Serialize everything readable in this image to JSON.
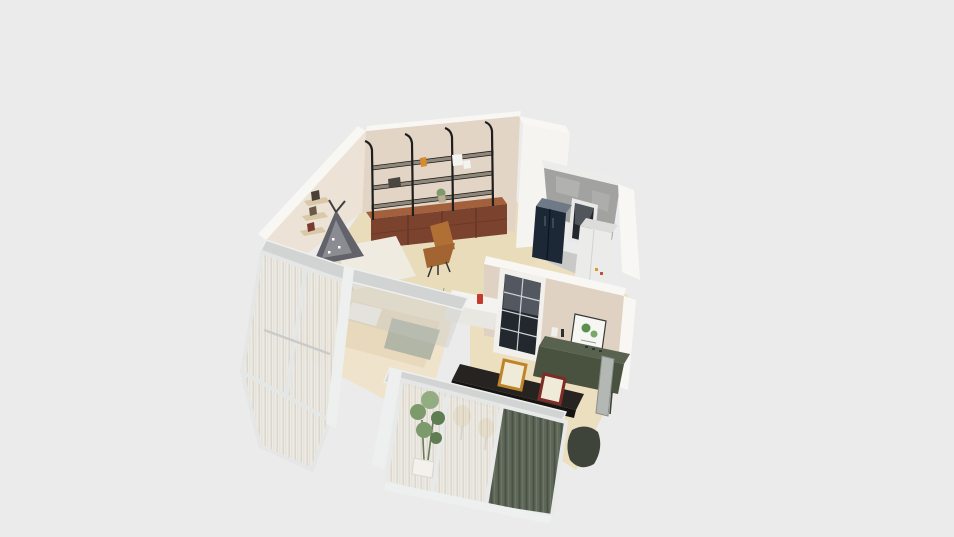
{
  "app": {
    "type": "3d-floorplan-render",
    "description": "Isometric 3D render of a small apartment floor plan on a plain grey canvas, no UI chrome or text visible"
  },
  "palette": {
    "background": "#ebebeb",
    "wall_top_white": "#f8f7f4",
    "wall_white_face": "#f5f4f0",
    "wall_beige": "#e3d5c6",
    "wall_beige_light": "#ece2d5",
    "wall_kitchen": "#e0d2c3",
    "floor_cream": "#e9dcbb",
    "floor_kitchen": "#ecdfc0",
    "floor_bedroom": "#efe3cc",
    "floor_utility": "#c9c9c7",
    "shelf_plank": "#8f887a",
    "shelf_frame_black": "#1e1e1e",
    "drawer_wood": "#7b432d",
    "drawer_wood_top": "#a2613c",
    "chair_caramel": "#b06f35",
    "chair_caramel_dark": "#a26430",
    "sofa_white": "#f0ebe0",
    "teepee_grey": "#62626a",
    "teepee_pattern": "#9a9aa0",
    "bed_blanket": "#e8d9bd",
    "bed_pillow": "#f5f2ea",
    "bedding_sage": "#b2b6a6",
    "curtain_sheer": "#edeae3",
    "curtain_stripe": "#d6d2c8",
    "window_frame": "#d2d4d3",
    "frame_post_white": "#eef0ef",
    "drape_green": "#5f6759",
    "drape_green_dark": "#4a5246",
    "fridge_navy": "#1d2836",
    "fridge_top": "#6e7a88",
    "concrete_grey": "#a2a2a0",
    "concrete_light": "#b8b8b6",
    "cabinet_white": "#ebebe9",
    "door_glass_dark": "#23272e",
    "door_glare": "#7b828a",
    "sideboard_green_top": "#59624f",
    "sideboard_green": "#49523f",
    "island_black": "#262320",
    "island_black_dark": "#161412",
    "stool_amber": "#c9983f",
    "frame_amber": "#c08428",
    "frame_red": "#7e2c26",
    "frame_canvas": "#f0ead9",
    "plant_green": "#7d9a6d",
    "plant_green_dark": "#5f7d52",
    "plant_green_light": "#93ad83",
    "pot_white": "#f2f1ec",
    "poster_white": "#f6f6f2",
    "poster_green": "#5a8f4e",
    "poster_green_light": "#7aa868",
    "counter_white": "#f4f3ef",
    "counter_white_side": "#e9e7e2",
    "accent_red_item": "#c23b2e",
    "mirror_grey": "#b4b8b4",
    "dark_chair": "#3e443a",
    "wood_light_shelf": "#d9c9a8"
  },
  "scene": {
    "objects": [
      {
        "name": "wall-shelving-unit",
        "note": "three black metal shelf bays on back wall"
      },
      {
        "name": "drawer-sideboard",
        "note": "reddish wood drawers under shelving"
      },
      {
        "name": "lounge-chair",
        "note": "caramel leather chair"
      },
      {
        "name": "wall-mounted-shelves",
        "note": "three small wooden shelves on left wall"
      },
      {
        "name": "play-teepee",
        "note": "patterned grey tent on white sofa"
      },
      {
        "name": "sofa",
        "note": "white sofa under teepee"
      },
      {
        "name": "bed",
        "note": "bed with beige blanket inside glass room"
      },
      {
        "name": "glass-partition",
        "note": "framed glass walls with sheer curtains"
      },
      {
        "name": "refrigerator",
        "note": "navy side-by-side fridge in utility room"
      },
      {
        "name": "utility-window",
        "note": "dark window in utility room"
      },
      {
        "name": "storage-cabinet",
        "note": "white cabinet in utility room"
      },
      {
        "name": "glass-panel-door",
        "note": "black framed 8-pane interior door"
      },
      {
        "name": "botanical-poster",
        "note": "framed green botanical print"
      },
      {
        "name": "console-desk",
        "note": "dark green sideboard desk"
      },
      {
        "name": "kitchen-island",
        "note": "black countertop island"
      },
      {
        "name": "bar-stools",
        "note": "amber stools behind curtains"
      },
      {
        "name": "picture-frame-amber",
        "note": "gold frame leaning on floor"
      },
      {
        "name": "picture-frame-red",
        "note": "dark red frame leaning on floor"
      },
      {
        "name": "potted-plant",
        "note": "tall plant behind window"
      },
      {
        "name": "green-drapes",
        "note": "dark green curtains on bottom windows"
      },
      {
        "name": "leaning-mirror",
        "note": "tall mirror against kitchen wall"
      }
    ]
  }
}
